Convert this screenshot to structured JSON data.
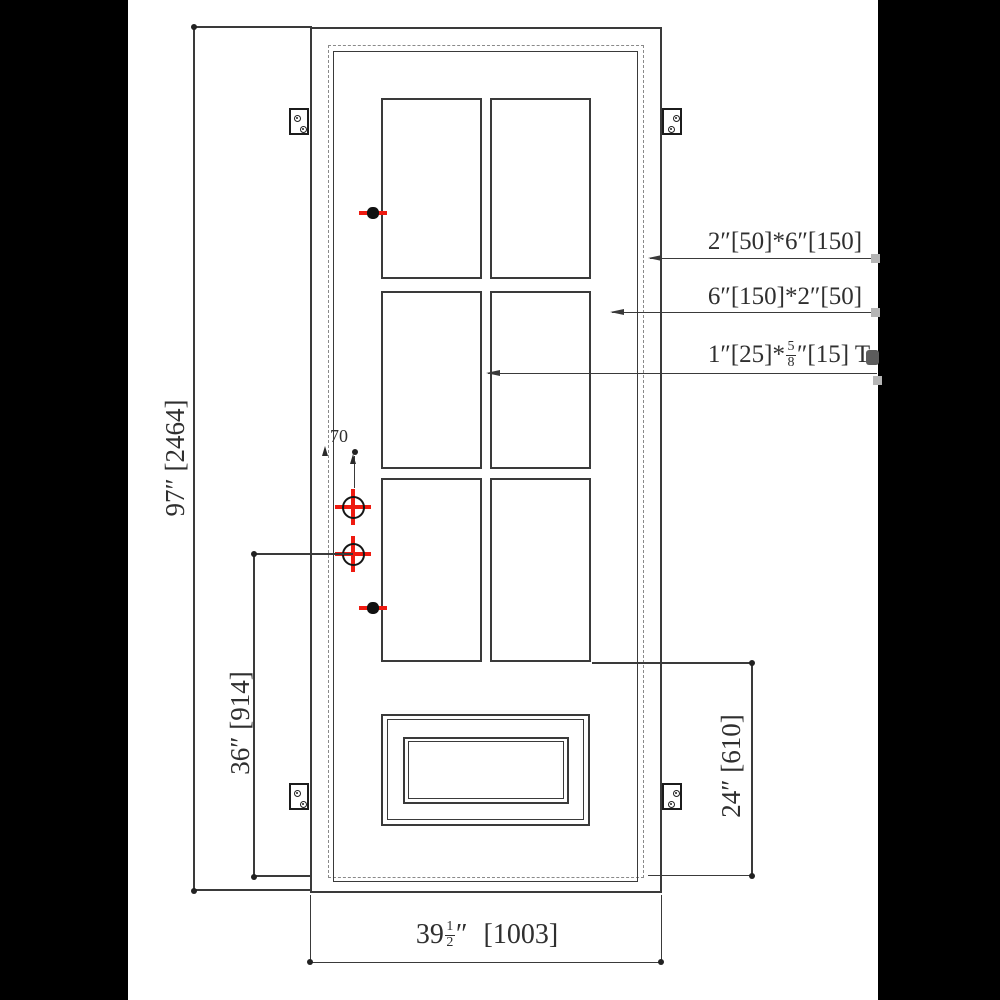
{
  "sheet": {
    "background": "#ffffff",
    "line_color": "#3a3a3a",
    "accent_red": "#ee1a10",
    "grip_gray": "#b5b5b5"
  },
  "callouts": {
    "frame_profile": {
      "text": "2″[50]*6″[150]"
    },
    "leaf_profile": {
      "text": "6″[150]*2″[50]"
    },
    "muntin_profile": {
      "pre": "1″[25]*",
      "frac_num": "5",
      "frac_den": "8",
      "post": "″[15] T"
    }
  },
  "dimensions": {
    "overall_height": "97″ [2464]",
    "handle_height": "36″ [914]",
    "bottom_section": "24″ [610]",
    "backset": "70",
    "overall_width": {
      "whole": "39",
      "frac_num": "1",
      "frac_den": "2",
      "suffix": "″",
      "metric": "[1003]"
    }
  }
}
